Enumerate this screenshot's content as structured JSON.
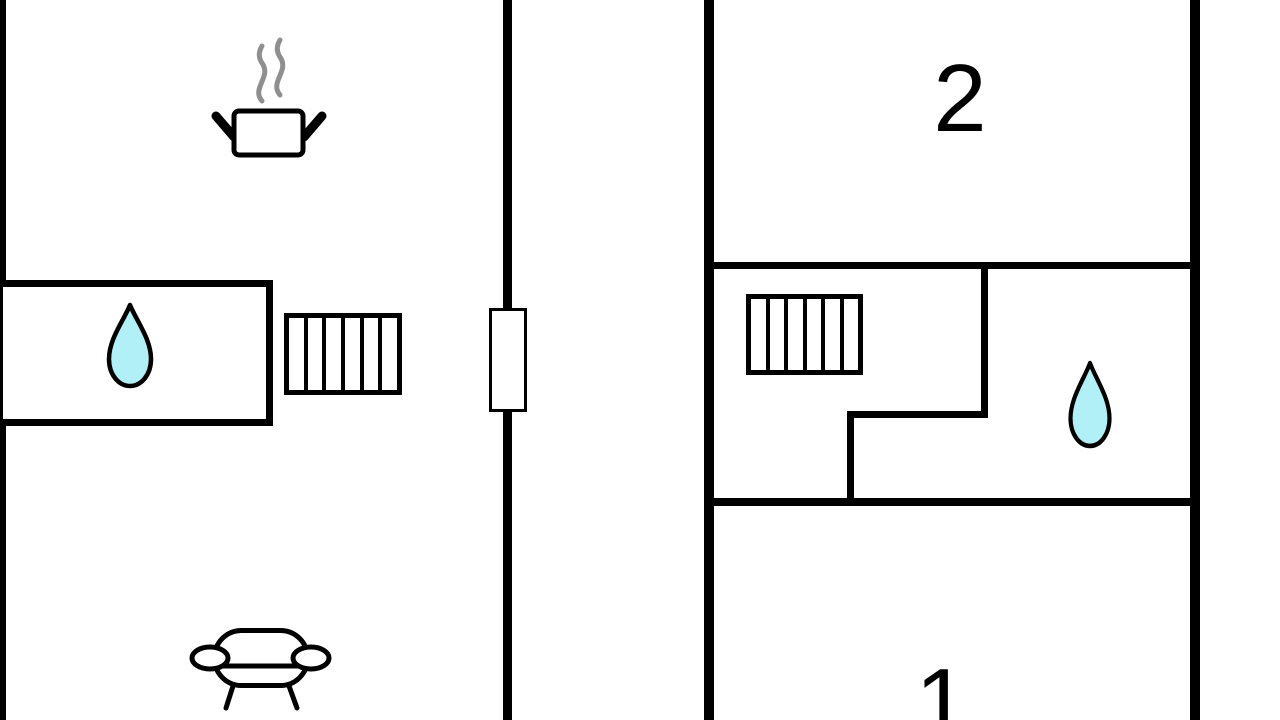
{
  "canvas": {
    "width": 1280,
    "height": 720,
    "background": "#ffffff",
    "type": "floor-plan-drawing"
  },
  "palette": {
    "wall": "#000000",
    "icon_outline": "#000000",
    "water": "#b2f0f7",
    "steam": "#8f8f8f",
    "text": "#000000"
  },
  "left_unit": {
    "features": [
      "cooking-pot",
      "bathroom-water-drop",
      "stairs-6-treads",
      "door-opening-on-center-wall",
      "sofa"
    ]
  },
  "right_unit": {
    "room2_label": "2",
    "room1_label": "1",
    "features": [
      "stairs-6-treads",
      "bathroom-water-drop"
    ]
  }
}
